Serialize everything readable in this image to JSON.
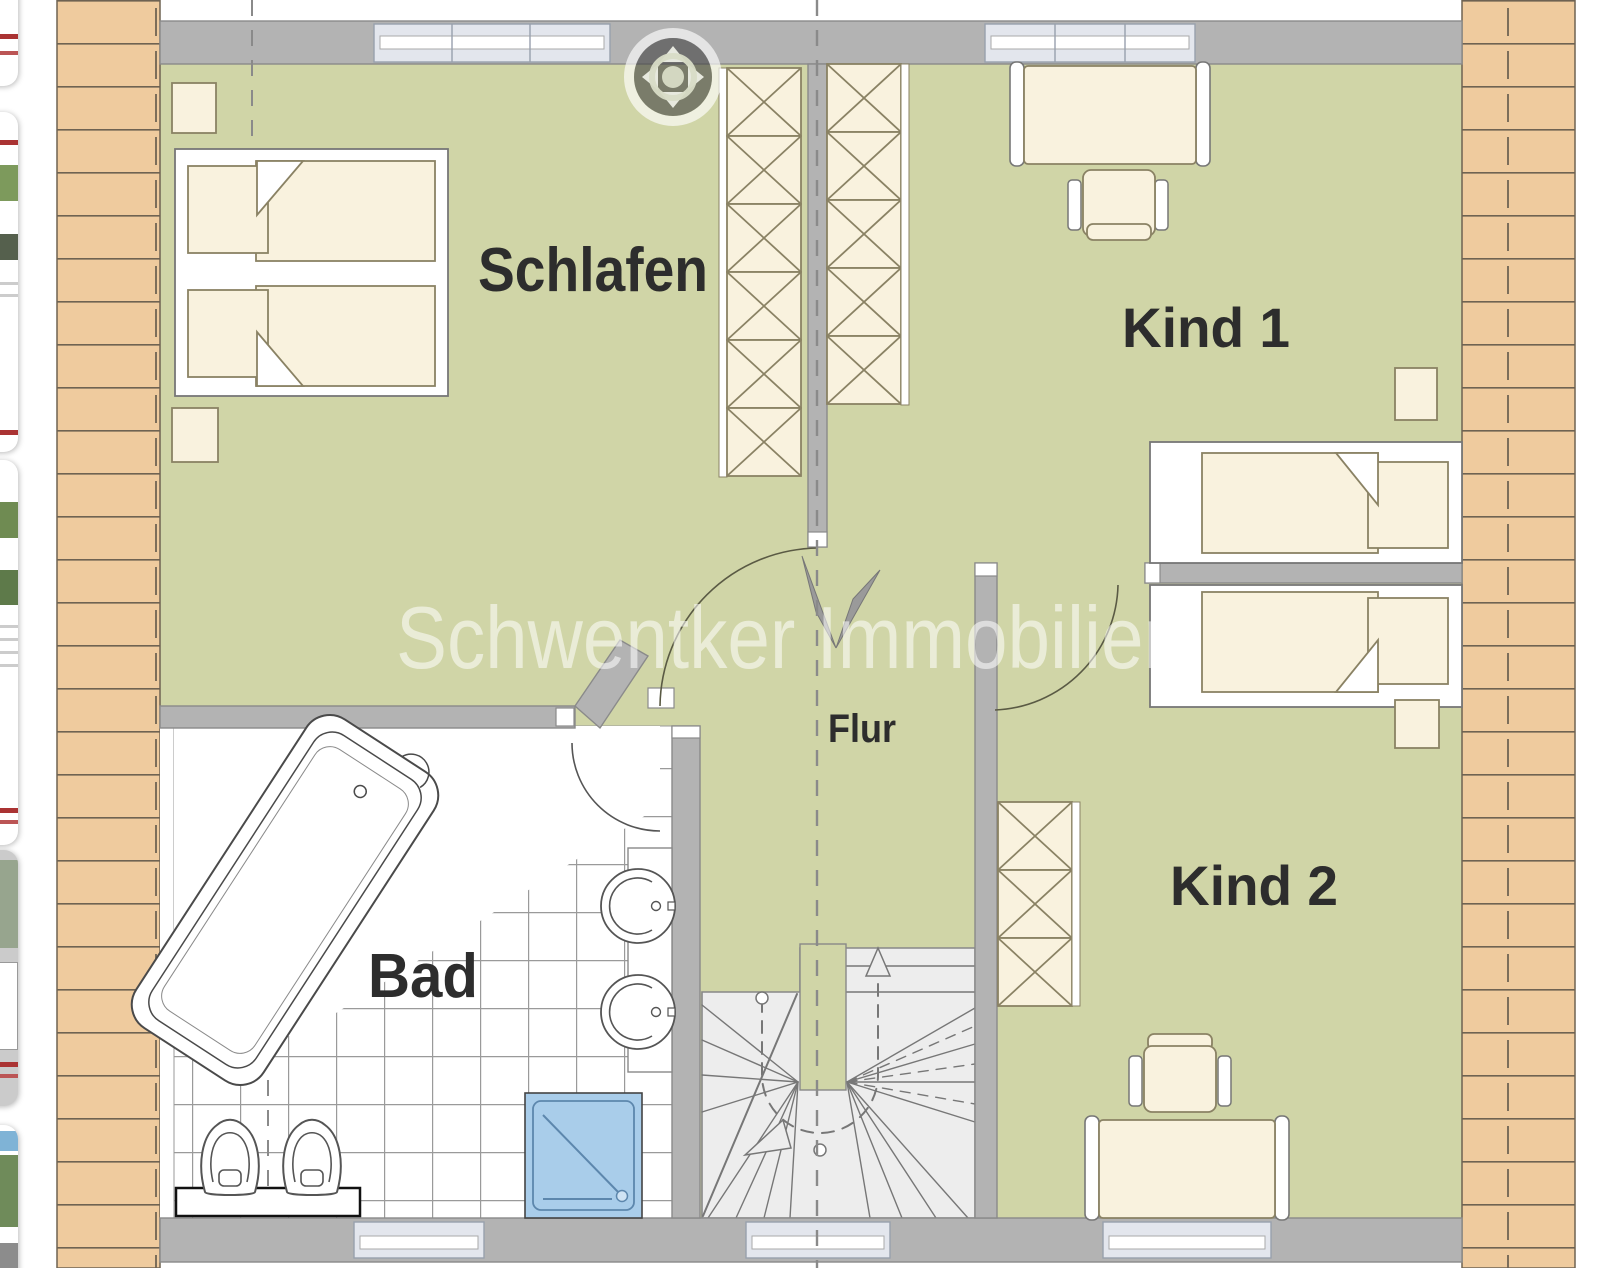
{
  "view": {
    "type": "floorplan-image-viewer"
  },
  "floorplan": {
    "watermark": "Schwentker Immobilien",
    "rooms": {
      "schlafen": "Schlafen",
      "kind1": "Kind 1",
      "kind2": "Kind 2",
      "bad": "Bad",
      "flur": "Flur"
    },
    "colors": {
      "floor_green": "#d0d5a7",
      "wall_gray": "#b3b3b3",
      "brick": "#efcb9e",
      "brick_line": "#6f6352",
      "furniture_cream": "#f9f2de",
      "furniture_line": "#8a8264",
      "shower_blue": "#a9cdea",
      "stairs_gray": "#ededed",
      "window_light": "#e3e6ed",
      "label_dark": "#2d2d2d"
    }
  },
  "controls": {
    "pan": {
      "label": "pan",
      "directions": [
        "up",
        "down",
        "left",
        "right"
      ]
    }
  },
  "sidebar": {
    "thumbnails": [
      {
        "position": 1,
        "selected": false
      },
      {
        "position": 2,
        "selected": false
      },
      {
        "position": 3,
        "selected": false
      },
      {
        "position": 4,
        "selected": true
      },
      {
        "position": 5,
        "selected": false
      }
    ]
  }
}
